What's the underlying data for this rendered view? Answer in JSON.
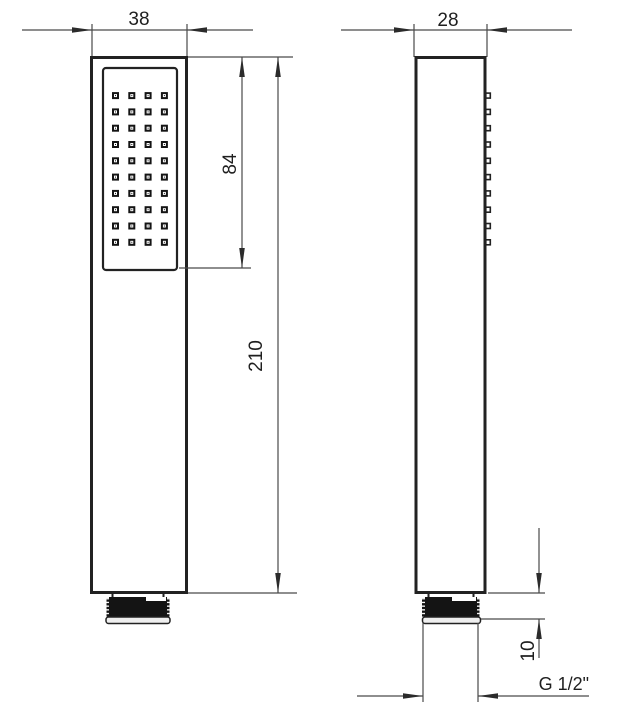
{
  "drawing": {
    "title": "Handheld shower head technical drawing",
    "views": {
      "front": {
        "name": "front-view",
        "width_label": "38",
        "face_length_label": "84",
        "total_length_label": "210",
        "nozzle_grid": {
          "cols": 4,
          "rows": 10
        }
      },
      "side": {
        "name": "side-view",
        "depth_label": "28",
        "thread_length_label": "10",
        "thread_spec_label": "G 1/2\"",
        "nozzle_rows": 10
      }
    },
    "colors": {
      "object_line": "#222222",
      "dim_line": "#4a4a4a",
      "thread_fill": "#141414",
      "cap_fill": "#efefef"
    }
  }
}
